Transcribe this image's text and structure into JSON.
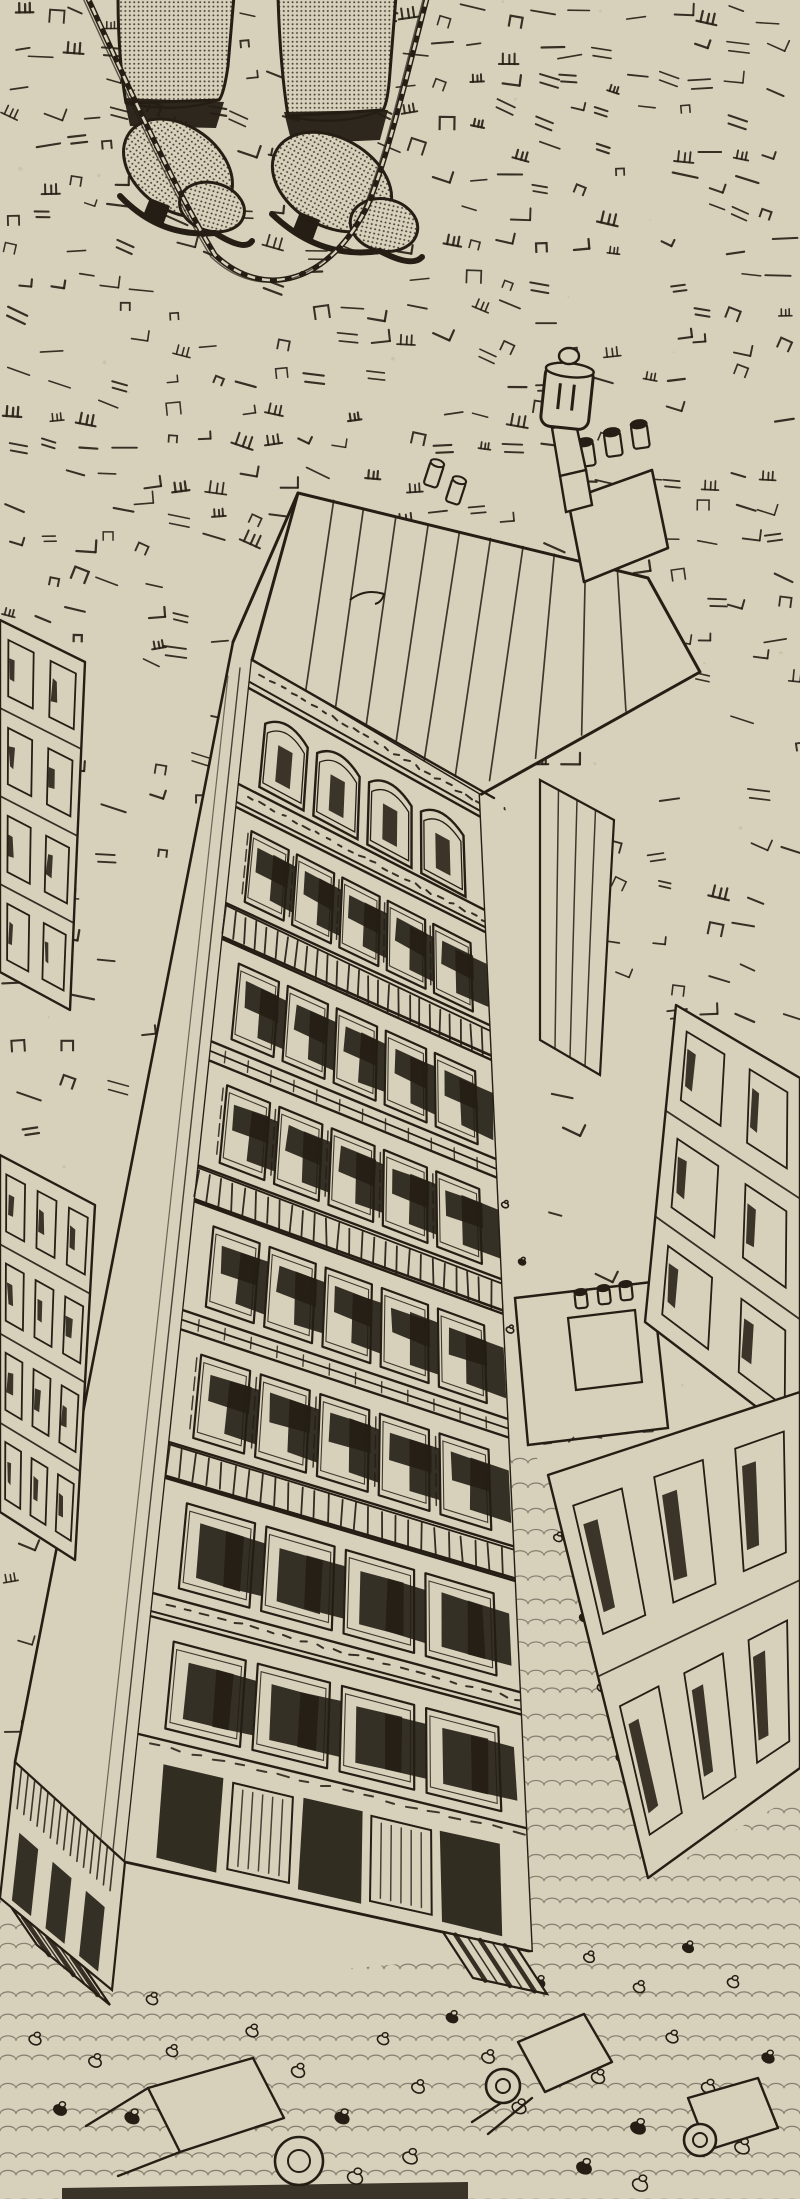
{
  "artwork": {
    "medium": "pen-and-ink-halftone-print",
    "subject": "vertigo-birds-eye-view-boots-dangling-on-rope-above-city-street",
    "palette": {
      "paper": "#d7d1bc",
      "ink": "#241e14",
      "ink_soft": "#4a4232"
    }
  },
  "scene": {
    "canvas": {
      "w": 800,
      "h": 2199
    },
    "texture": {
      "seed": 11,
      "zones": [
        [
          0,
          0,
          800,
          648,
          33,
          0.72
        ],
        [
          0,
          648,
          246,
          1760,
          46,
          0.55
        ],
        [
          468,
          648,
          800,
          1058,
          44,
          0.6
        ],
        [
          540,
          1058,
          800,
          1395,
          48,
          0.5
        ]
      ],
      "speck_count": 70
    },
    "figure": {
      "trousers": [
        "M118,-4 L234,-4 L228,66 Q224,94 219,100 L126,103 Q118,58 118,-4 Z",
        "M278,-4 L396,-4 L390,72 Q388,102 383,110 L288,116 Q280,66 278,-4 Z"
      ],
      "cuffs": [
        "M126,103 Q176,114 219,100",
        "M288,116 Q338,128 383,110"
      ],
      "shadows": [
        [
          [
            124,
            98
          ],
          [
            224,
            102
          ],
          [
            216,
            128
          ],
          [
            130,
            126
          ]
        ],
        [
          [
            284,
            112
          ],
          [
            388,
            110
          ],
          [
            380,
            140
          ],
          [
            292,
            144
          ]
        ]
      ],
      "boots": [
        {
          "body": [
            178,
            168,
            60,
            42,
            36
          ],
          "toe": [
            212,
            207,
            33,
            24,
            16
          ],
          "sole": "M120,196 Q160,238 215,233 Q245,252 252,241",
          "heel": [
            [
              150,
              198
            ],
            [
              170,
              206
            ],
            [
              162,
              228
            ],
            [
              142,
              218
            ]
          ]
        },
        {
          "body": [
            332,
            182,
            64,
            44,
            30
          ],
          "toe": [
            384,
            225,
            34,
            26,
            12
          ],
          "sole": "M272,214 Q320,260 380,251 Q412,268 422,257",
          "heel": [
            [
              300,
              212
            ],
            [
              320,
              220
            ],
            [
              312,
              242
            ],
            [
              292,
              232
            ]
          ]
        }
      ],
      "rope_loop": "M86,-6 C130,90 170,180 215,255 C265,302 330,282 368,205 C390,150 408,70 428,-6"
    },
    "building": {
      "facade": {
        "TL": [
          252,
          660
        ],
        "TR": [
          480,
          795
        ],
        "BR": [
          533,
          1952
        ],
        "BL": [
          125,
          1862
        ]
      },
      "floors": [
        {
          "k": "cornice",
          "w": 2.2
        },
        {
          "k": "arch",
          "w": 7.5,
          "n": 4
        },
        {
          "k": "cornice",
          "w": 1.8
        },
        {
          "k": "win",
          "w": 7.5,
          "n": 5,
          "shutter": true
        },
        {
          "k": "rail",
          "w": 2.8
        },
        {
          "k": "win",
          "w": 8.0,
          "n": 5
        },
        {
          "k": "sill",
          "w": 1.5
        },
        {
          "k": "win",
          "w": 8.2,
          "n": 5,
          "shutter": true
        },
        {
          "k": "rail",
          "w": 2.8
        },
        {
          "k": "win",
          "w": 8.5,
          "n": 5
        },
        {
          "k": "sill",
          "w": 1.5
        },
        {
          "k": "win",
          "w": 8.8,
          "n": 5,
          "shutter": true
        },
        {
          "k": "rail",
          "w": 2.8
        },
        {
          "k": "win",
          "w": 9.0,
          "n": 4,
          "dark": true
        },
        {
          "k": "cornice",
          "w": 1.8
        },
        {
          "k": "win",
          "w": 9.2,
          "n": 4,
          "dark": true
        },
        {
          "k": "shop",
          "w": 10.0
        }
      ],
      "left_wall": [
        [
          298,
          493
        ],
        [
          233,
          642
        ],
        [
          15,
          1762
        ],
        [
          125,
          1862
        ],
        [
          252,
          660
        ]
      ],
      "roof": {
        "outline": [
          [
            298,
            493
          ],
          [
            648,
            578
          ],
          [
            700,
            672
          ],
          [
            480,
            795
          ],
          [
            252,
            660
          ]
        ],
        "stripe_us": [
          0.1,
          0.19,
          0.28,
          0.37,
          0.46,
          0.55,
          0.64,
          0.73,
          0.82,
          0.91
        ],
        "swirl": "M350,600 q15,-12 34,-6 q-2,8 -9,10",
        "chimney_box": [
          [
            568,
            500
          ],
          [
            652,
            470
          ],
          [
            668,
            548
          ],
          [
            584,
            582
          ]
        ],
        "box_pots": [
          [
            588,
            466,
            16,
            24,
            -8
          ],
          [
            615,
            456,
            16,
            24,
            -8
          ],
          [
            642,
            448,
            16,
            24,
            -8
          ]
        ],
        "edge_pots": [
          [
            430,
            486,
            14,
            24,
            18
          ],
          [
            452,
            503,
            14,
            24,
            18
          ]
        ],
        "pipe_segs": [
          [
            [
              552,
              428
            ],
            [
              576,
              424
            ],
            [
              586,
              470
            ],
            [
              560,
              476
            ]
          ],
          [
            [
              560,
              476
            ],
            [
              586,
              470
            ],
            [
              592,
              505
            ],
            [
              566,
              512
            ]
          ]
        ],
        "can": {
          "x": 543,
          "y": 366,
          "w": 48,
          "h": 62,
          "rot": 6,
          "knob": [
            569,
            356,
            10,
            8
          ]
        }
      }
    },
    "shops_left": {
      "quad": [
        [
          15,
          1762
        ],
        [
          125,
          1862
        ],
        [
          112,
          1990
        ],
        [
          0,
          1898
        ]
      ],
      "awning": [
        [
          11,
          1907
        ],
        [
          84,
          1967
        ],
        [
          110,
          2005
        ],
        [
          37,
          1945
        ]
      ]
    },
    "street": {
      "poly": [
        [
          480,
          795
        ],
        [
          545,
          835
        ],
        [
          549,
          1288
        ],
        [
          532,
          1450
        ],
        [
          549,
          1478
        ],
        [
          652,
          1878
        ],
        [
          800,
          1793
        ],
        [
          800,
          2199
        ],
        [
          0,
          2199
        ],
        [
          0,
          1900
        ],
        [
          112,
          1990
        ],
        [
          533,
          1952
        ]
      ],
      "cobble_top": 1462,
      "crowd": [
        [
          95,
          2062,
          1,
          0
        ],
        [
          132,
          2118,
          1.1,
          1
        ],
        [
          172,
          2052,
          0.9,
          0
        ],
        [
          213,
          2094,
          1,
          1
        ],
        [
          252,
          2032,
          0.95,
          0
        ],
        [
          298,
          2072,
          1.05,
          0
        ],
        [
          342,
          2118,
          1.1,
          1
        ],
        [
          383,
          2040,
          0.9,
          0
        ],
        [
          418,
          2088,
          1,
          0
        ],
        [
          452,
          2018,
          0.9,
          1
        ],
        [
          488,
          2058,
          1,
          0
        ],
        [
          519,
          2108,
          1.1,
          0
        ],
        [
          557,
          2032,
          0.95,
          1
        ],
        [
          598,
          2078,
          1.05,
          0
        ],
        [
          638,
          2128,
          1.15,
          1
        ],
        [
          672,
          2038,
          0.95,
          0
        ],
        [
          708,
          2088,
          1.05,
          0
        ],
        [
          742,
          2148,
          1.15,
          0
        ],
        [
          768,
          2058,
          0.95,
          1
        ],
        [
          733,
          1983,
          0.9,
          0
        ],
        [
          688,
          1948,
          0.85,
          1
        ],
        [
          639,
          1988,
          0.9,
          0
        ],
        [
          589,
          1958,
          0.85,
          0
        ],
        [
          539,
          1983,
          0.9,
          1
        ],
        [
          640,
          2185,
          1.2,
          0
        ],
        [
          584,
          2168,
          1.15,
          1
        ],
        [
          410,
          2158,
          1.15,
          0
        ],
        [
          355,
          2178,
          1.2,
          0
        ],
        [
          152,
          2000,
          0.9,
          0
        ],
        [
          60,
          2110,
          1,
          1
        ],
        [
          35,
          2040,
          0.95,
          0
        ],
        [
          558,
          1538,
          0.7,
          0
        ],
        [
          584,
          1618,
          0.72,
          1
        ],
        [
          602,
          1688,
          0.75,
          0
        ],
        [
          621,
          1758,
          0.78,
          0
        ],
        [
          641,
          1828,
          0.8,
          1
        ],
        [
          608,
          1560,
          0.7,
          0
        ],
        [
          505,
          1205,
          0.55,
          0
        ],
        [
          522,
          1262,
          0.57,
          1
        ],
        [
          510,
          1330,
          0.6,
          0
        ]
      ],
      "carts": [
        {
          "body": [
            [
              148,
              2088
            ],
            [
              253,
              2058
            ],
            [
              284,
              2118
            ],
            [
              180,
              2152
            ]
          ],
          "wheel": [
            299,
            2161,
            24,
            11
          ],
          "shafts": [
            [
              [
                148,
                2088
              ],
              [
                86,
                2126
              ]
            ],
            [
              [
                180,
                2152
              ],
              [
                118,
                2176
              ]
            ]
          ]
        },
        {
          "body": [
            [
              518,
              2042
            ],
            [
              584,
              2014
            ],
            [
              612,
              2062
            ],
            [
              545,
              2092
            ]
          ],
          "wheel": [
            503,
            2086,
            17,
            7
          ],
          "shafts": [
            [
              [
                518,
                2092
              ],
              [
                472,
                2122
              ]
            ],
            [
              [
                532,
                2098
              ],
              [
                488,
                2134
              ]
            ]
          ]
        },
        {
          "body": [
            [
              688,
              2098
            ],
            [
              758,
              2078
            ],
            [
              778,
              2128
            ],
            [
              708,
              2150
            ]
          ],
          "wheel": [
            700,
            2140,
            16,
            7
          ],
          "shafts": []
        }
      ],
      "awning_main": [
        [
          443,
          1932
        ],
        [
          517,
          1948
        ],
        [
          547,
          1994
        ],
        [
          473,
          1978
        ]
      ]
    },
    "neighbors": {
      "sliver": [
        [
          540,
          780
        ],
        [
          614,
          820
        ],
        [
          600,
          1075
        ],
        [
          540,
          1040
        ]
      ],
      "roof_n": {
        "quad": [
          [
            515,
            1298
          ],
          [
            652,
            1282
          ],
          [
            668,
            1428
          ],
          [
            528,
            1445
          ]
        ],
        "box": [
          [
            568,
            1318
          ],
          [
            635,
            1310
          ],
          [
            642,
            1382
          ],
          [
            576,
            1390
          ]
        ],
        "pots": [
          [
            582,
            1308,
            12,
            16,
            -6
          ],
          [
            605,
            1304,
            12,
            16,
            -6
          ],
          [
            627,
            1300,
            12,
            16,
            -6
          ]
        ]
      },
      "facade_r1": {
        "quad": [
          [
            676,
            1005
          ],
          [
            800,
            1078
          ],
          [
            800,
            1440
          ],
          [
            645,
            1322
          ]
        ],
        "rows": 3,
        "cols": 2
      },
      "facade_r2": {
        "quad": [
          [
            548,
            1475
          ],
          [
            800,
            1392
          ],
          [
            800,
            1768
          ],
          [
            648,
            1878
          ]
        ],
        "rows": 2,
        "cols": 3
      }
    },
    "left_edge_panels": [
      {
        "quad": [
          [
            0,
            620
          ],
          [
            85,
            662
          ],
          [
            70,
            1010
          ],
          [
            0,
            972
          ]
        ],
        "rows": 4,
        "cols": 2
      },
      {
        "quad": [
          [
            0,
            1155
          ],
          [
            95,
            1205
          ],
          [
            75,
            1560
          ],
          [
            0,
            1512
          ]
        ],
        "rows": 4,
        "cols": 3
      }
    ],
    "print_edge_band": [
      [
        62,
        2188
      ],
      [
        468,
        2182
      ],
      [
        468,
        2199
      ],
      [
        62,
        2199
      ]
    ]
  }
}
